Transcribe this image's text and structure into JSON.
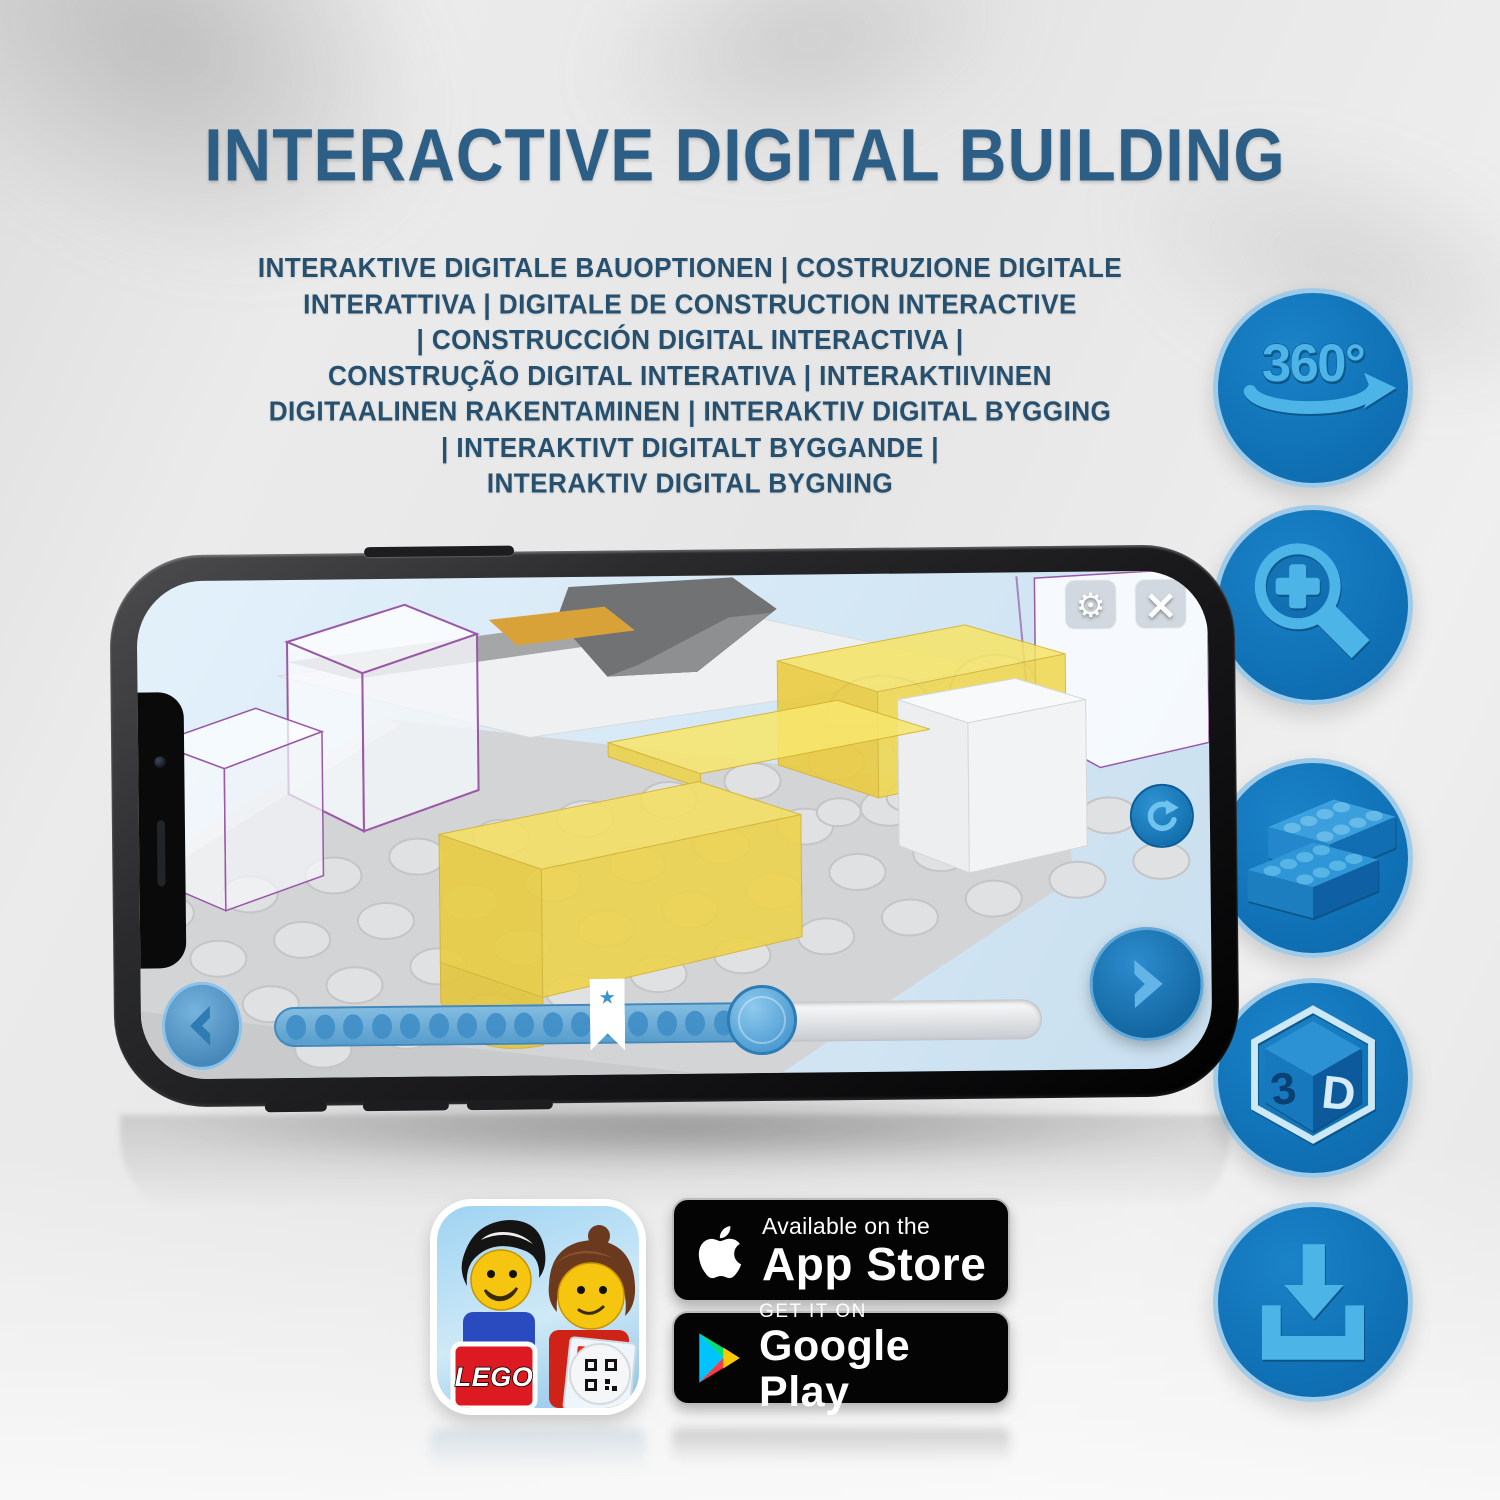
{
  "title": "INTERACTIVE DIGITAL BUILDING",
  "subtitle_lines": [
    "INTERAKTIVE DIGITALE BAUOPTIONEN | COSTRUZIONE DIGITALE",
    "INTERATTIVA | DIGITALE DE CONSTRUCTION INTERACTIVE",
    "| CONSTRUCCIÓN DIGITAL INTERACTIVA |",
    "CONSTRUÇÃO DIGITAL INTERATIVA | INTERAKTIIVINEN",
    "DIGITAALINEN RAKENTAMINEN | INTERAKTIV DIGITAL BYGGING",
    "| INTERAKTIVT DIGITALT BYGGANDE |",
    "INTERAKTIV DIGITAL BYGNING"
  ],
  "phone_app": {
    "settings_glyph": "⚙",
    "close_glyph": "×",
    "bookmark_glyph": "★",
    "slider": {
      "progress_pct": 64,
      "bookmark_pct": 43,
      "dot_count": 17
    }
  },
  "features": {
    "rotate_label": "360°",
    "cube_3": "3",
    "cube_d": "D",
    "icon_names": [
      "360-rotation",
      "zoom-in",
      "lego-brick",
      "3d-view",
      "download"
    ]
  },
  "app_icon": {
    "logo_text": "LEGO"
  },
  "badges": {
    "app_store": {
      "tagline": "Available on the",
      "name": "App Store"
    },
    "google_play": {
      "tagline": "GET IT ON",
      "name": "Google Play"
    }
  },
  "colors": {
    "accent_blue": "#1173b8",
    "icon_glyph_blue": "#4db4e8",
    "title_blue": "#2d5f86",
    "subtitle_blue": "#26506e",
    "ghost_outline_purple": "#9a58a8",
    "brick_yellow": "#f0d94e",
    "screen_sky": "#d9eaf6",
    "badge_black": "#040404"
  }
}
